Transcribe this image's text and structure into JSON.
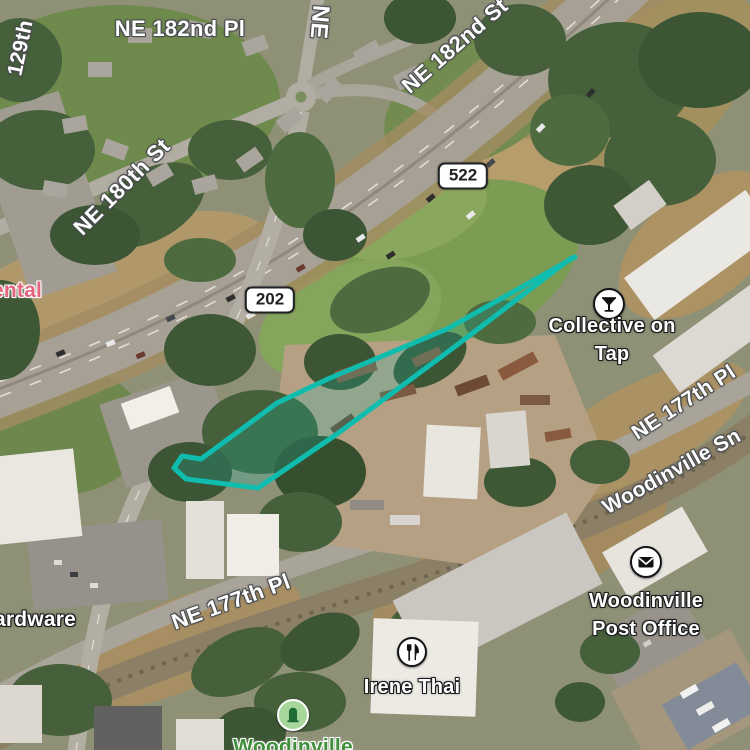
{
  "map": {
    "type": "satellite",
    "area": "Woodinville, WA — SR 522 / SR 202 interchange"
  },
  "road_labels": [
    {
      "id": "ne-182nd-pl",
      "text": "NE 182nd Pl"
    },
    {
      "id": "129th",
      "text": "129th"
    },
    {
      "id": "ne-vertical",
      "text": "NE"
    },
    {
      "id": "ne-182nd-st",
      "text": "NE 182nd St"
    },
    {
      "id": "ne-180th-st",
      "text": "NE 180th St"
    },
    {
      "id": "ne-177th-pl-upper",
      "text": "NE 177th Pl"
    },
    {
      "id": "woodinville-snohomish",
      "text": "Woodinville Sn"
    },
    {
      "id": "ne-177th-pl-lower",
      "text": "NE 177th Pl"
    }
  ],
  "route_shields": [
    {
      "number": "522"
    },
    {
      "number": "202"
    }
  ],
  "pois": [
    {
      "id": "collective-on-tap",
      "name": "Collective on Tap",
      "icon": "martini-icon"
    },
    {
      "id": "woodinville-post-office",
      "name": "Woodinville\nPost Office",
      "icon": "mail-icon"
    },
    {
      "id": "irene-thai",
      "name": "Irene Thai",
      "icon": "restaurant-icon"
    },
    {
      "id": "woodinville-park",
      "name": "Woodinville",
      "icon": "memorial-icon",
      "label_color": "#3f8f3d"
    },
    {
      "id": "rental-clipped",
      "name": "ental",
      "label_color": "#e4647e"
    },
    {
      "id": "hardware-clipped",
      "name": "ardware"
    }
  ],
  "route": {
    "color": "#0fbcae",
    "fill": "rgba(16,188,174,0.22)",
    "stroke_width": 5,
    "points": [
      [
        575,
        257
      ],
      [
        447,
        329
      ],
      [
        330,
        378
      ],
      [
        277,
        403
      ],
      [
        201,
        459
      ],
      [
        182,
        456
      ],
      [
        174,
        468
      ],
      [
        186,
        479
      ],
      [
        258,
        488
      ],
      [
        337,
        434
      ],
      [
        457,
        345
      ],
      [
        570,
        259
      ]
    ]
  }
}
